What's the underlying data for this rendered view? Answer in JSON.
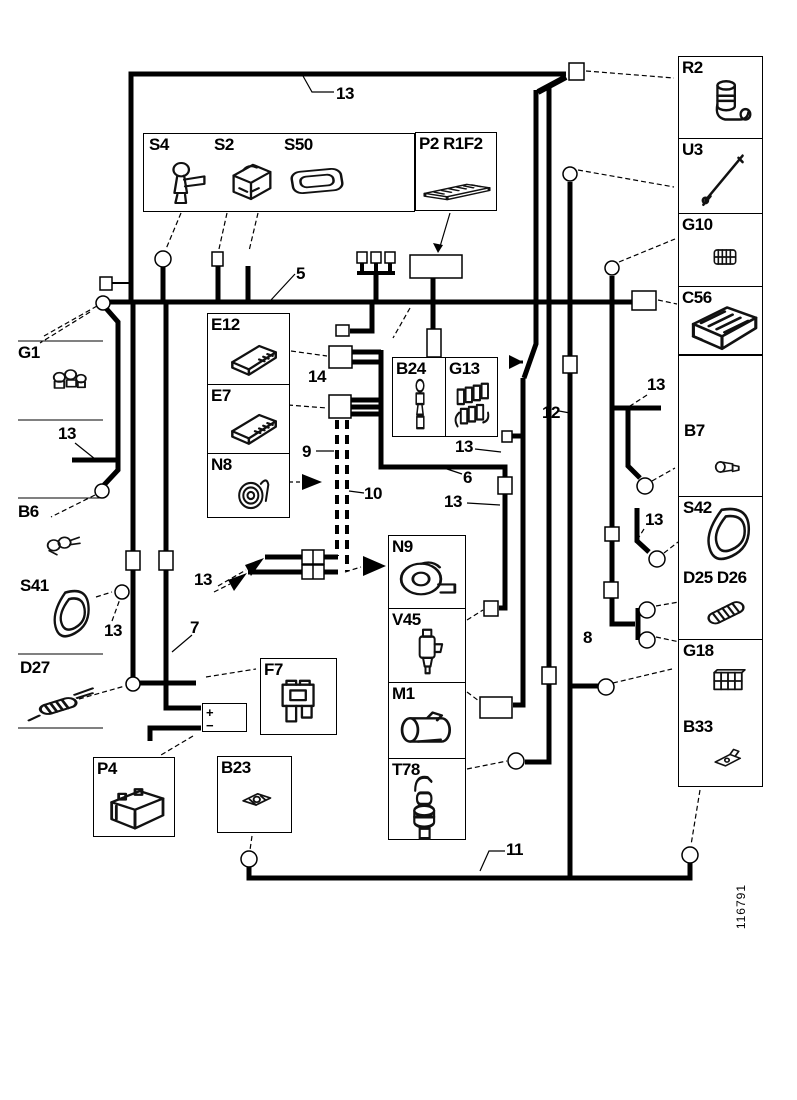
{
  "figure_number": "116791",
  "top_group": {
    "items": [
      {
        "label": "S4",
        "icon": "sensor-key"
      },
      {
        "label": "S2",
        "icon": "switch-block"
      },
      {
        "label": "S50",
        "icon": "module-rounded"
      }
    ]
  },
  "p2_group": {
    "label": "P2 R1F2",
    "icon": "flat-board"
  },
  "right_top_column": [
    {
      "label": "R2",
      "icon": "pump"
    },
    {
      "label": "U3",
      "icon": "antenna"
    },
    {
      "label": "G10",
      "icon": "ribbed-connector"
    },
    {
      "label": "C56",
      "icon": "hatched-box"
    }
  ],
  "right_bottom_column": [
    {
      "label": "B7",
      "icon": "small-sender"
    },
    {
      "label": "S42",
      "icon": "seal-ring-large"
    },
    {
      "label": "D25 D26",
      "icon": "striped-connector"
    },
    {
      "label": "G18",
      "icon": "ribbed-block"
    },
    {
      "label": "B33",
      "icon": "clip-sensor"
    }
  ],
  "ecu_column": [
    {
      "label": "E12",
      "icon": "ecu-box"
    },
    {
      "label": "E7",
      "icon": "ecu-box2"
    },
    {
      "label": "N8",
      "icon": "horn"
    }
  ],
  "b24_group": [
    {
      "label": "B24",
      "icon": "sensor-chain"
    },
    {
      "label": "G13",
      "icon": "glow-rail"
    }
  ],
  "center_column": [
    {
      "label": "N9",
      "icon": "blower-motor"
    },
    {
      "label": "V45",
      "icon": "valve"
    },
    {
      "label": "M1",
      "icon": "starter-motor"
    },
    {
      "label": "T78",
      "icon": "probe-sensor"
    }
  ],
  "margin_items": [
    {
      "label": "G1",
      "icon": "bulb-cluster"
    },
    {
      "label": "B6",
      "icon": "plug-sensor"
    },
    {
      "label": "S41",
      "icon": "seal-ring"
    },
    {
      "label": "D27",
      "icon": "cable-splice"
    }
  ],
  "standalone_boxes": [
    {
      "label": "P4",
      "icon": "battery"
    },
    {
      "label": "B23",
      "icon": "bracket-clip"
    },
    {
      "label": "F7",
      "icon": "blade-fuse"
    }
  ],
  "battery_terminals": {
    "plus": "+",
    "minus": "−"
  },
  "callouts": [
    {
      "text": "13"
    },
    {
      "text": "5"
    },
    {
      "text": "14"
    },
    {
      "text": "9"
    },
    {
      "text": "10"
    },
    {
      "text": "6"
    },
    {
      "text": "12"
    },
    {
      "text": "13"
    },
    {
      "text": "13"
    },
    {
      "text": "13"
    },
    {
      "text": "7"
    },
    {
      "text": "13"
    },
    {
      "text": "13"
    },
    {
      "text": "13"
    },
    {
      "text": "13"
    },
    {
      "text": "8"
    },
    {
      "text": "11"
    }
  ]
}
